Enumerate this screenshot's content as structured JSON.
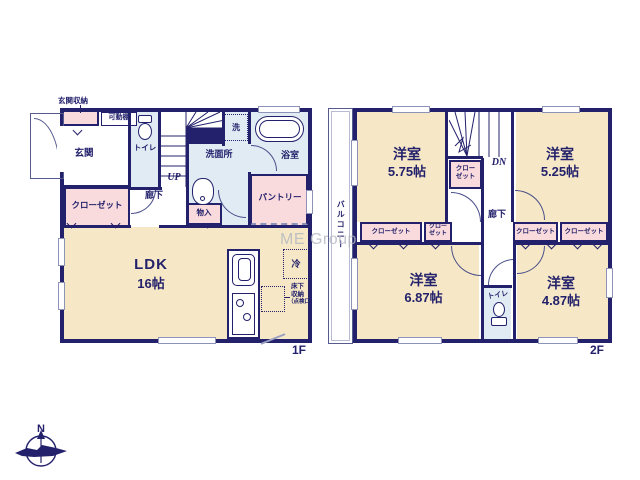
{
  "watermark": "ME Group",
  "compass": {
    "north": "N"
  },
  "colors": {
    "wall_navy": "#23216b",
    "room_cream": "#f6e8c6",
    "closet_pink": "#f9dbdd",
    "wet_area_blue": "#e0ebf4",
    "watermark_gray": "#b9bcc6"
  },
  "floor1": {
    "label": "1F",
    "entrance_storage": "玄関収納",
    "movable_shelf": "可動棚",
    "entrance": "玄関",
    "closet": "クローゼット",
    "toilet": "トイレ",
    "stairs": "UP",
    "hallway": "廊下",
    "storage": "物入",
    "washer": "洗",
    "washroom": "洗面所",
    "bathroom": "浴室",
    "pantry": "パントリー",
    "ldk_name": "LDK",
    "ldk_size": "16帖",
    "fridge": "冷",
    "underfloor": {
      "line1": "床下",
      "line2": "収納",
      "line3": "（点検口）"
    }
  },
  "floor2": {
    "label": "2F",
    "balcony": "バルコニー",
    "stairs": "DN",
    "hallway": "廊下",
    "toilet": "トイレ",
    "closet": "クローゼット",
    "closet_split": {
      "line1": "クロー",
      "line2": "ゼット"
    },
    "rooms": [
      {
        "name": "洋室",
        "size": "5.75帖"
      },
      {
        "name": "洋室",
        "size": "5.25帖"
      },
      {
        "name": "洋室",
        "size": "6.87帖"
      },
      {
        "name": "洋室",
        "size": "4.87帖"
      }
    ]
  }
}
